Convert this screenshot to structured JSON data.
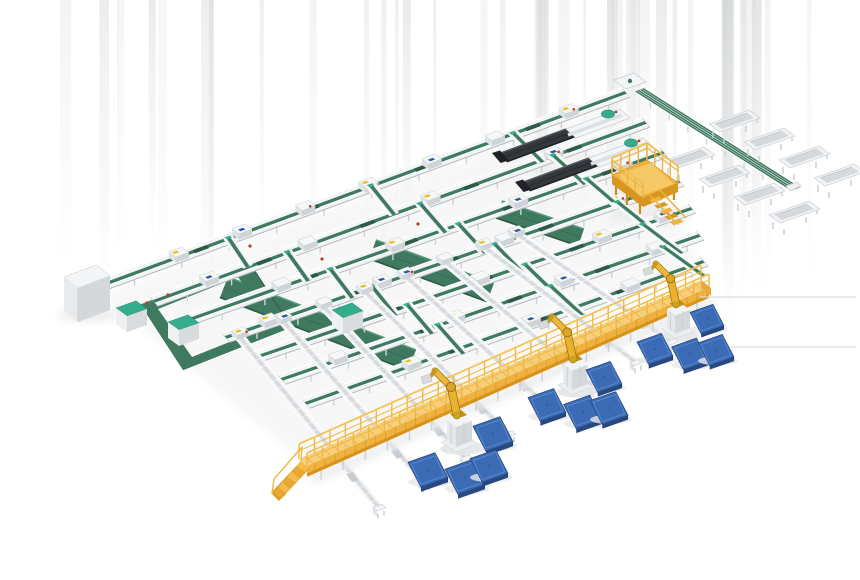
{
  "meta": {
    "title": "Automated parcel sorting and palletizing system - isometric 3D render",
    "background": "#ffffff"
  },
  "palette": {
    "conveyor_green": "#3f7a60",
    "conveyor_green_dark": "#2c5a45",
    "conveyor_green_light": "#579a7c",
    "rail_white": "#f2f4f5",
    "rail_edge": "#c6cbd0",
    "steel_gray": "#dfe2e5",
    "steel_gray_dark": "#cfd3d7",
    "tray_gray": "#d7dade",
    "walkway_yellow": "#efb23f",
    "walkway_yellow_light": "#f7cf79",
    "walkway_yellow_dark": "#d8931f",
    "walkway_rail": "#f3c152",
    "robot_yellow": "#e9b22e",
    "robot_yellow_dark": "#9a7110",
    "pallet_blue": "#3b6bb5",
    "pallet_blue_dark": "#27497f",
    "pallet_blue_light": "#5d8bd0",
    "machine_dark": "#34383d",
    "machine_darker": "#1f2226",
    "teal_accent": "#35ad8c",
    "shadow_gray": "#e7e8e9",
    "floor_line": "#dcdddd",
    "dot_red": "#c0392b",
    "dot_blue": "#2458a8",
    "dot_yellow": "#e9c11f"
  },
  "inventory": {
    "sorter_lines": 7,
    "cross_connectors": 18,
    "through_lanes": 8,
    "induct_modules": 30,
    "palletizing_robots": 3,
    "pallets": 12,
    "telescopic_unloaders": 2,
    "operator_platforms": 1,
    "elevated_walkways": 1,
    "walkway_ramps": 1,
    "recirculation_loops": 1,
    "supply_cabinets": 3,
    "infeed_enclosures": 1,
    "takeaway_conveyors": 1,
    "chute_tables": 8,
    "floor_belts": 3,
    "floor_marking_lines": 2
  },
  "groups": [
    {
      "name": "background-streaks",
      "label": "render background streaks"
    },
    {
      "name": "floor-belts",
      "label": "wide green floor belts"
    },
    {
      "name": "recirculation-loop",
      "label": "green recirculation loop conveyor"
    },
    {
      "name": "sorter-lines",
      "label": "green belt sorter lines"
    },
    {
      "name": "cross-lanes",
      "label": "inclined transfer lanes"
    },
    {
      "name": "takeaway-conveyor",
      "label": "takeaway conveyor with chute tables"
    },
    {
      "name": "telescopic-unloaders",
      "label": "telescopic truck unloaders"
    },
    {
      "name": "operator-mezzanine",
      "label": "operator mezzanine platform"
    },
    {
      "name": "elevated-walkway",
      "label": "elevated service walkway with ramp"
    },
    {
      "name": "palletizing-robots",
      "label": "robotic palletizer arms"
    },
    {
      "name": "pallets",
      "label": "blue pallets"
    }
  ]
}
